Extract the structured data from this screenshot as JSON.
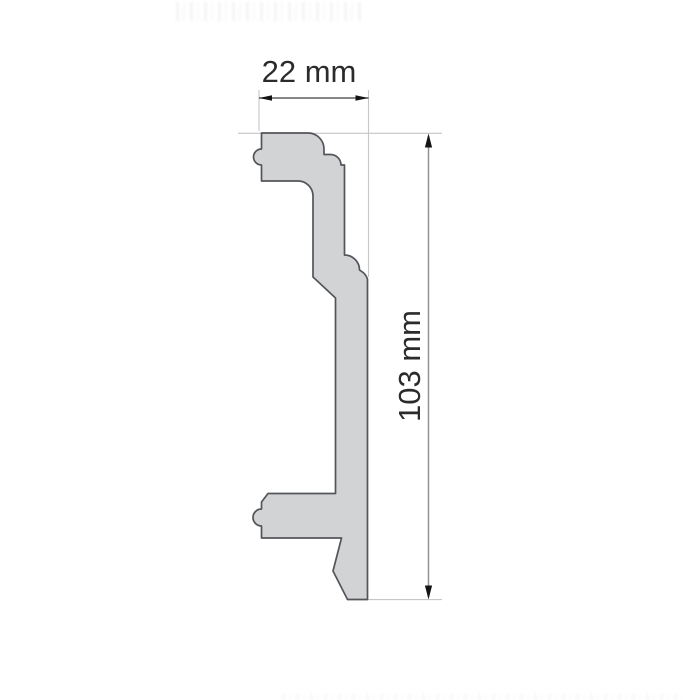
{
  "page": {
    "background": "#ffffff"
  },
  "drawing": {
    "subject": "moulding-profile-cross-section",
    "width_dimension": {
      "label": "22 mm"
    },
    "height_dimension": {
      "label": "103 mm"
    },
    "colors": {
      "profile_fill": "#d2d3d4",
      "profile_outline": "#54555a",
      "width_dim_line": "#3d3d3d",
      "height_dim_line": "#939393",
      "extension_line": "#c6c6c6",
      "arrow_fill": "#141414",
      "label_text": "#2b2b2b"
    }
  }
}
